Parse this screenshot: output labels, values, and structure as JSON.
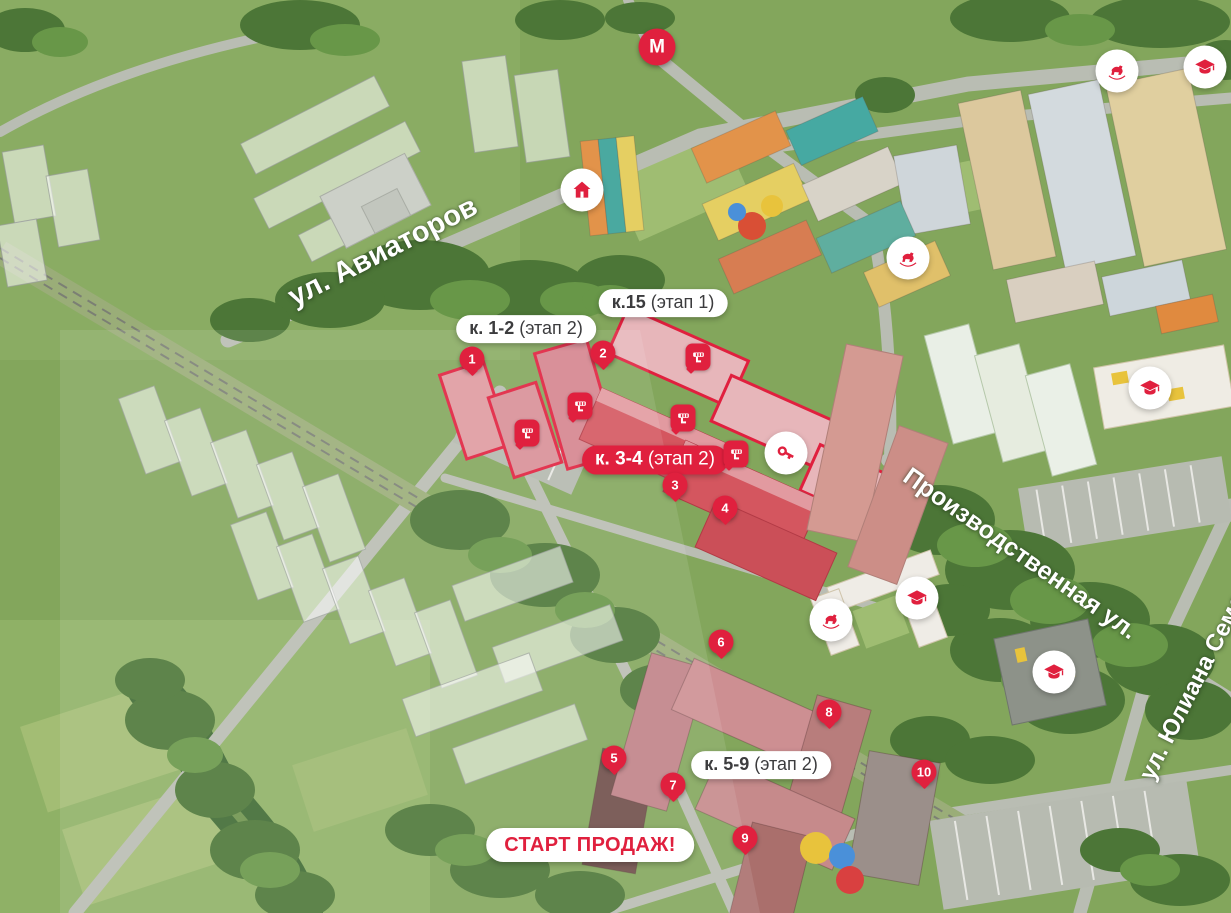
{
  "map": {
    "colors": {
      "accent": "#e0203e",
      "pill_text": "#3c3c3e",
      "pill_bg": "#ffffff"
    },
    "street_labels": [
      {
        "id": "aviatorov",
        "text": "ул. Авиаторов",
        "x": 383,
        "y": 252,
        "angle": -27,
        "size": 29
      },
      {
        "id": "proizvodstvennaya",
        "text": "Производственная ул.",
        "x": 1020,
        "y": 554,
        "angle": 35,
        "size": 25
      },
      {
        "id": "yuliana-semenova",
        "text": "ул. Юлиана Семенова",
        "x": 1206,
        "y": 662,
        "angle": -63,
        "size": 24
      }
    ],
    "building_labels": [
      {
        "id": "k15",
        "bold": "к.15",
        "rest": " (этап 1)",
        "x": 663,
        "y": 303,
        "style": "white"
      },
      {
        "id": "k1-2",
        "bold": "к. 1-2",
        "rest": " (этап 2)",
        "x": 526,
        "y": 329,
        "style": "white"
      },
      {
        "id": "k3-4",
        "bold": "к. 3-4",
        "rest": " (этап 2)",
        "x": 655,
        "y": 460,
        "style": "red"
      },
      {
        "id": "k5-9",
        "bold": "к. 5-9",
        "rest": " (этап 2)",
        "x": 761,
        "y": 765,
        "style": "white"
      }
    ],
    "sales_banner": {
      "text": "СТАРТ ПРОДАЖ!",
      "x": 590,
      "y": 845
    },
    "metro": {
      "label": "М",
      "x": 657,
      "y": 47
    },
    "markers": [
      {
        "n": "1",
        "x": 472,
        "y": 359
      },
      {
        "n": "2",
        "x": 603,
        "y": 353
      },
      {
        "n": "3",
        "x": 675,
        "y": 485
      },
      {
        "n": "4",
        "x": 725,
        "y": 508
      },
      {
        "n": "5",
        "x": 614,
        "y": 758
      },
      {
        "n": "6",
        "x": 721,
        "y": 642
      },
      {
        "n": "7",
        "x": 673,
        "y": 785
      },
      {
        "n": "8",
        "x": 829,
        "y": 712
      },
      {
        "n": "9",
        "x": 745,
        "y": 838
      },
      {
        "n": "10",
        "x": 924,
        "y": 772
      }
    ],
    "amenities": [
      {
        "icon": "home",
        "x": 582,
        "y": 190
      },
      {
        "icon": "rocking-horse",
        "x": 908,
        "y": 258
      },
      {
        "icon": "rocking-horse",
        "x": 1117,
        "y": 71
      },
      {
        "icon": "graduation-cap",
        "x": 1205,
        "y": 67
      },
      {
        "icon": "graduation-cap",
        "x": 1150,
        "y": 388
      },
      {
        "icon": "rocking-horse",
        "x": 831,
        "y": 620
      },
      {
        "icon": "graduation-cap",
        "x": 917,
        "y": 598
      },
      {
        "icon": "graduation-cap",
        "x": 1054,
        "y": 672
      },
      {
        "icon": "key",
        "x": 786,
        "y": 453
      }
    ],
    "construction_badges": [
      {
        "x": 527,
        "y": 433
      },
      {
        "x": 580,
        "y": 406
      },
      {
        "x": 698,
        "y": 357
      },
      {
        "x": 683,
        "y": 418
      },
      {
        "x": 736,
        "y": 454
      }
    ]
  }
}
